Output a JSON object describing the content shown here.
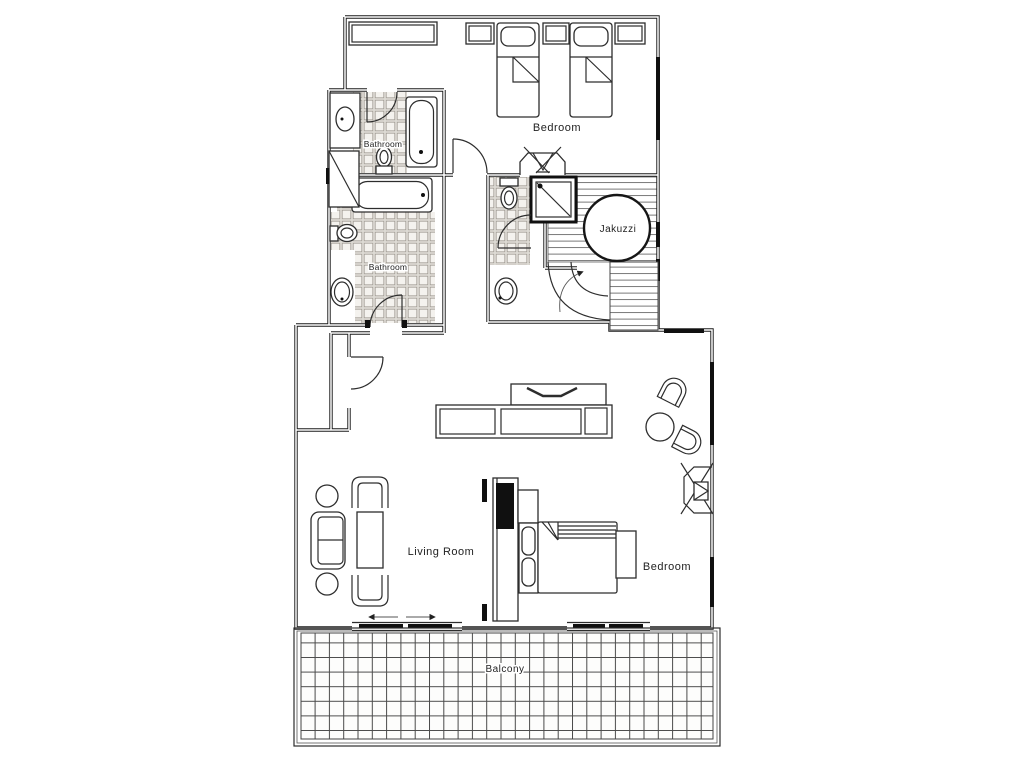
{
  "title": "Apartment floor plan",
  "rooms": {
    "bedroom_top": "Bedroom",
    "bathroom_upper": "Bathroom",
    "bathroom_lower": "Bathroom",
    "jacuzzi": "Jakuzzi",
    "living_room": "Living Room",
    "bedroom_lower": "Bedroom",
    "balcony": "Balcony"
  },
  "fixtures": [
    "twin-bed",
    "twin-bed",
    "nightstand",
    "closet",
    "bathtub",
    "bathtub",
    "toilet",
    "toilet",
    "toilet",
    "sink",
    "sink",
    "sink",
    "shower-stall",
    "jacuzzi-tub",
    "stairs",
    "tv-console",
    "dining-table",
    "tub-chair",
    "loveseat",
    "armchair",
    "coffee-table",
    "side-table",
    "double-bed",
    "tv-partition",
    "bench",
    "sliding-door",
    "sliding-door",
    "wall-unit"
  ],
  "colors": {
    "ink": "#1c1c1c",
    "paper": "#ffffff",
    "tile_fill": "#f4f2ee",
    "tile_grout": "#9a958c",
    "deck_line": "#6a6a6a"
  }
}
